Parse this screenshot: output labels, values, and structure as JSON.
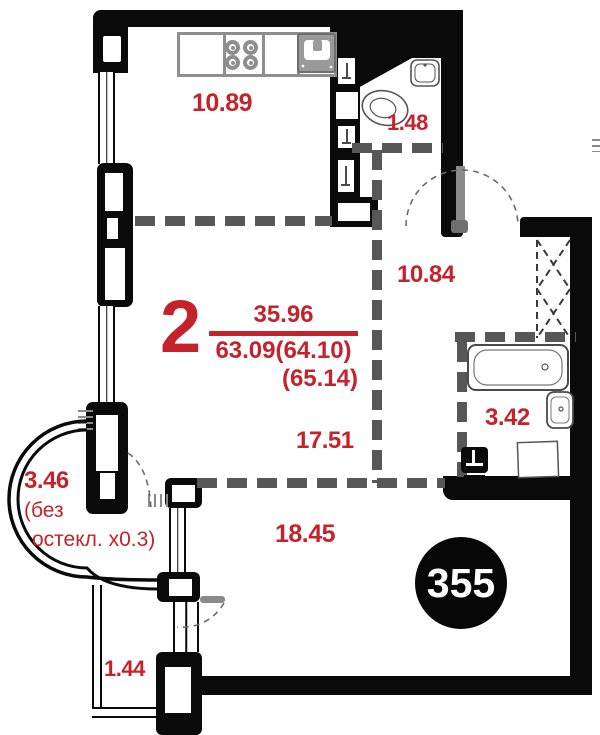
{
  "title": "apartment-floor-plan",
  "apartment_number": "355",
  "summary": {
    "room_count": "2",
    "living_area": "35.96",
    "total_area": "63.09(64.10)",
    "total_area_alt": "(65.14)"
  },
  "labels": {
    "kitchen": "10.89",
    "wc": "1.48",
    "hallway": "10.84",
    "bathroom": "3.42",
    "room_upper": "17.51",
    "room_lower": "18.45",
    "balcony_round": "3.46",
    "balcony_note_line1": "(без",
    "balcony_note_line2": "остекл. x0.3)",
    "balcony_small": "1.44"
  },
  "colors": {
    "label_red": "#c4232b",
    "wall_black": "#0a0a0a",
    "partition_gray": "#575757",
    "fixture_gray": "#8e8e8e",
    "badge_bg": "#070707",
    "badge_text": "#ffffff"
  },
  "icons": [
    "stove-burners-icon",
    "kitchen-sink-icon",
    "washbasin-icon",
    "toilet-icon",
    "bathtub-icon",
    "washing-machine-icon",
    "towel-rail-icon",
    "wardrobe-cross-icon",
    "door-swing-icon",
    "radiator-icon",
    "window-icon",
    "vent-shaft-icon"
  ]
}
